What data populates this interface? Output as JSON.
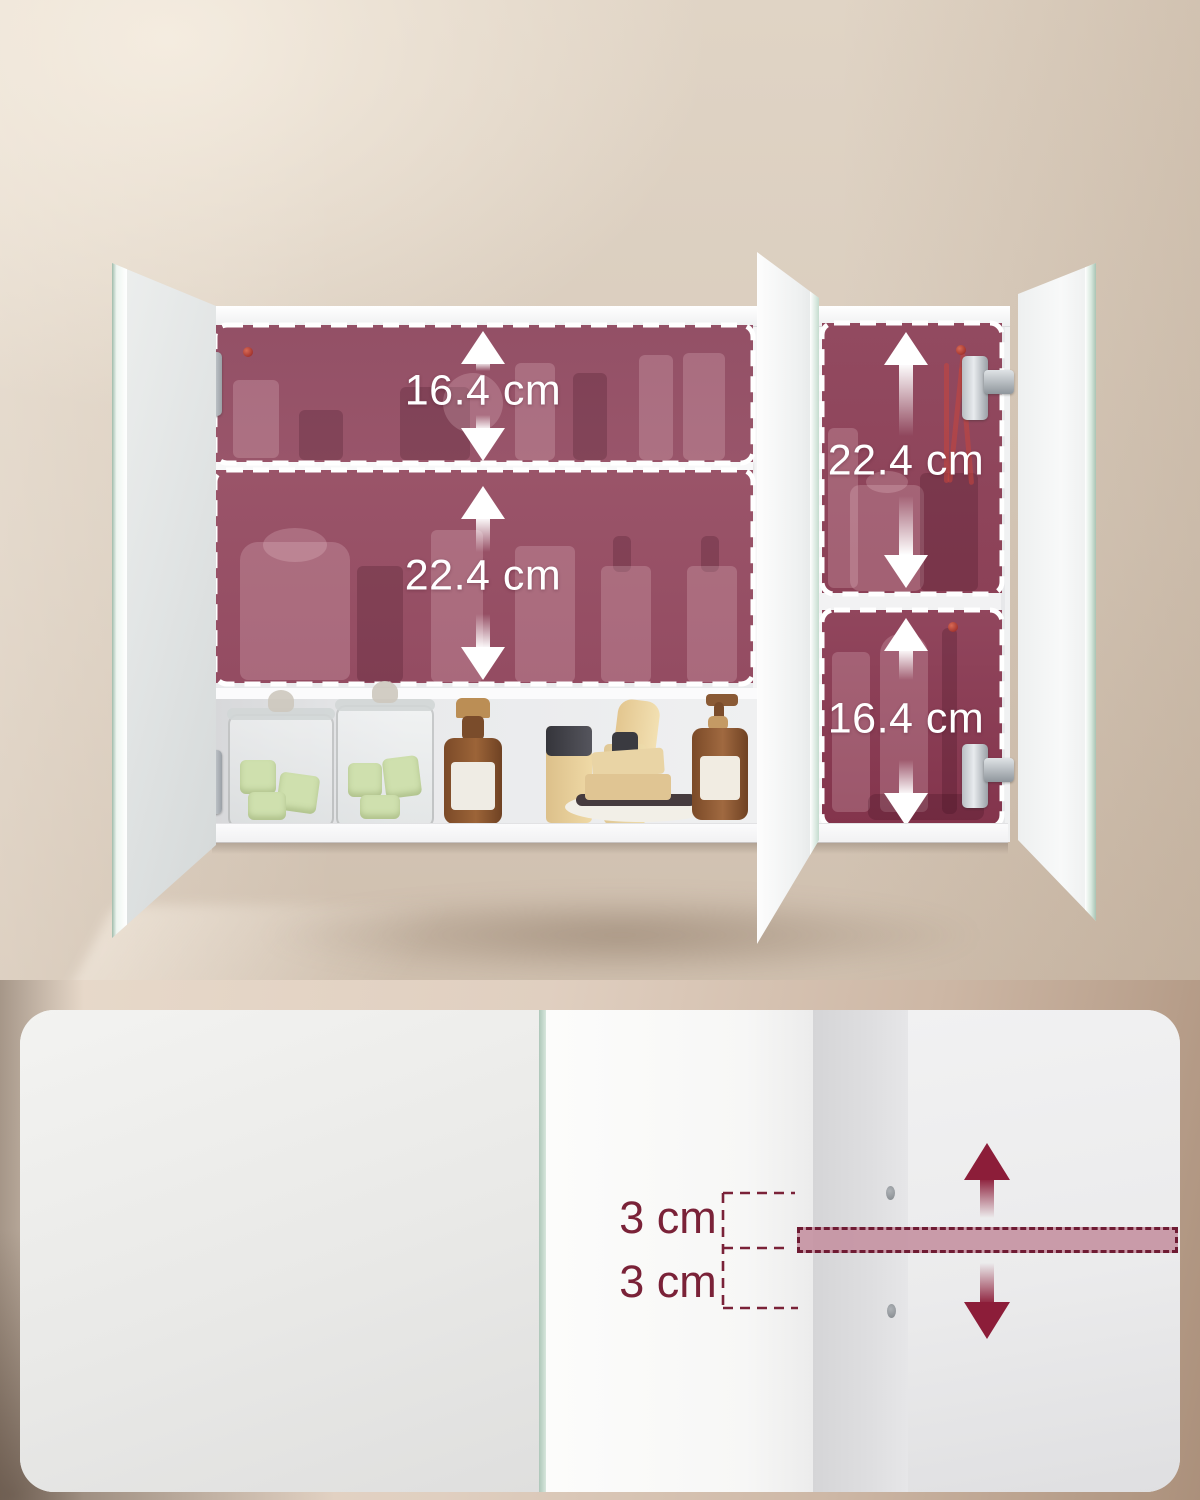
{
  "scene": {
    "type": "product-dimension-infographic",
    "subject": "3-door mirror bathroom wall cabinet with adjustable shelves"
  },
  "annotations": {
    "left_top_compartment": "16.4 cm",
    "left_middle_compartment": "22.4 cm",
    "right_top_compartment": "22.4 cm",
    "right_bottom_compartment": "16.4 cm",
    "shelf_spacing_upper": "3 cm",
    "shelf_spacing_lower": "3 cm"
  },
  "colors": {
    "highlight_overlay": "#97506a",
    "dash_border": "#ffffff",
    "dimension_text": "#ffffff",
    "shelf_highlight": "#c694a3",
    "shelf_dash_border": "#6f1b33",
    "spacing_text": "#7a2238",
    "accent_arrow": "#8c1d39",
    "wall": "#d8cbbc"
  }
}
